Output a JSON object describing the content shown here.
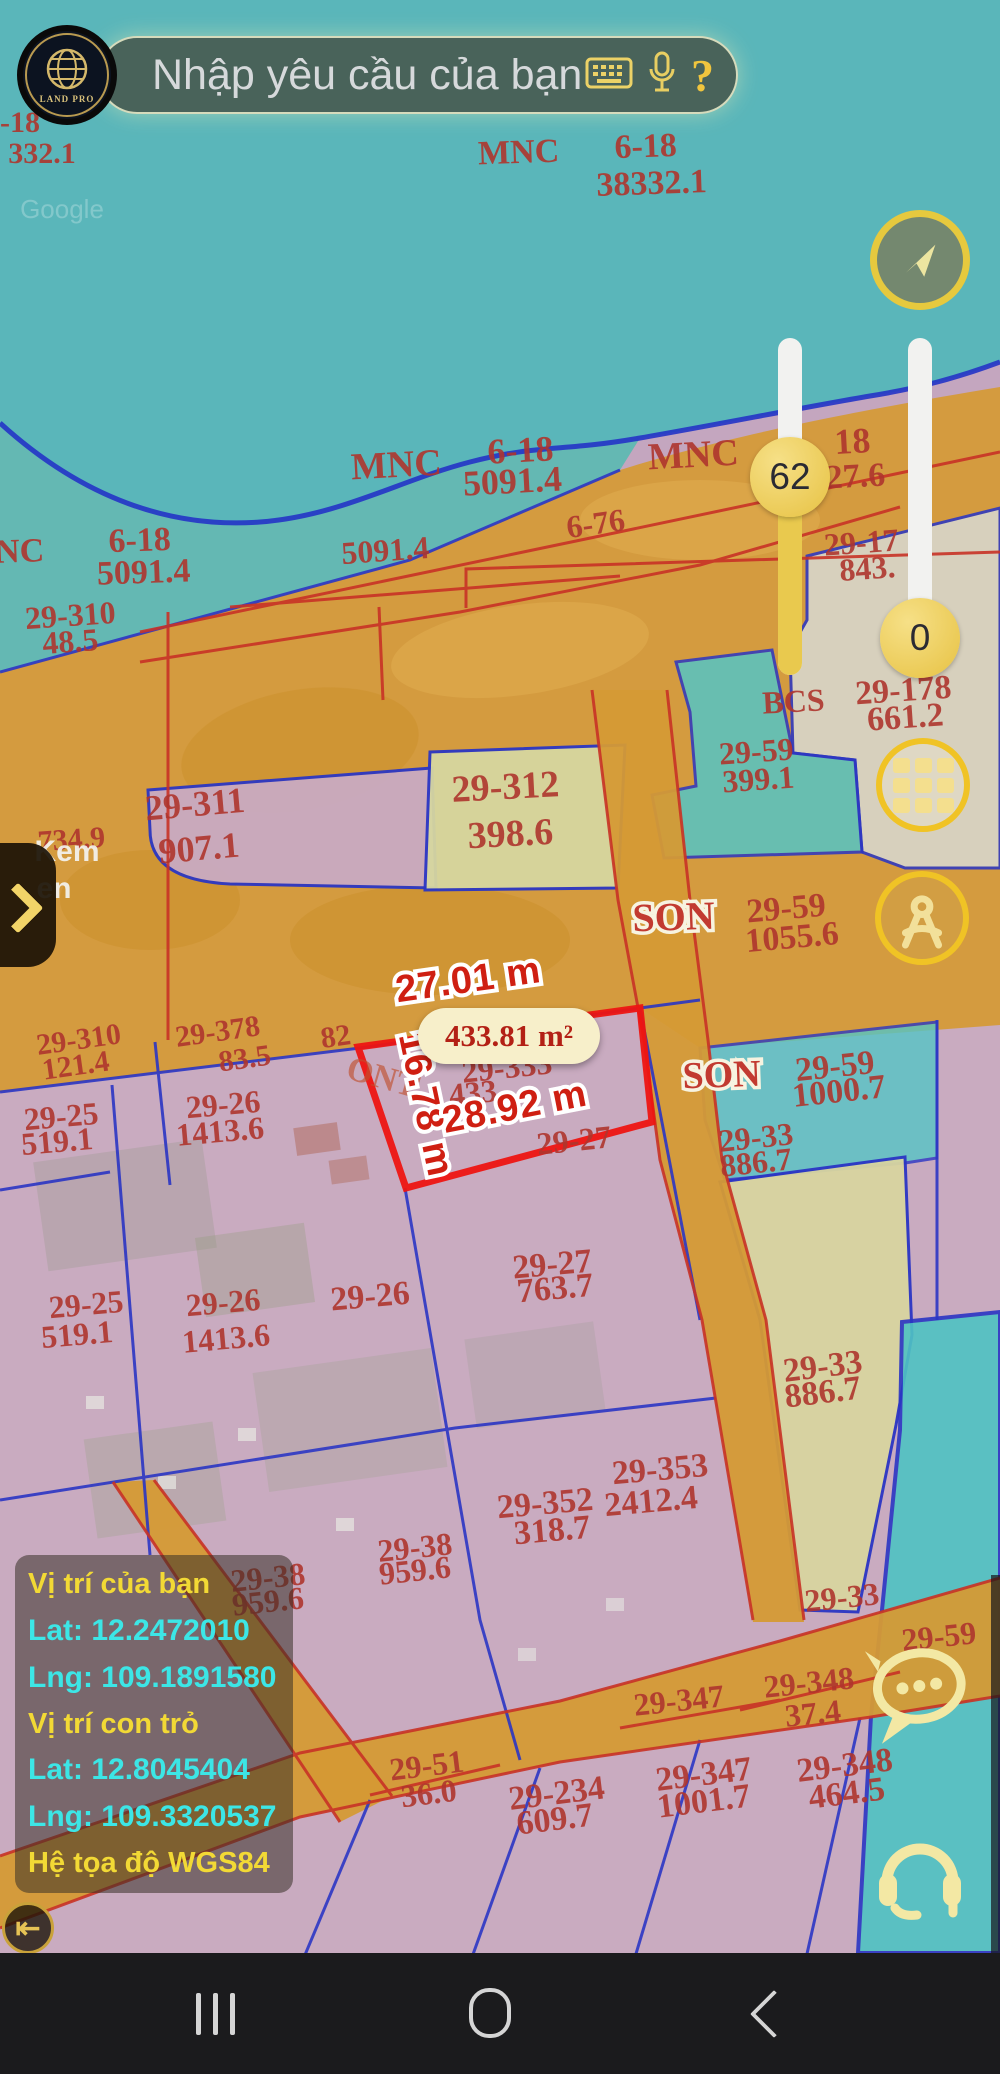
{
  "app": {
    "search_placeholder": "Nhập yêu cầu của bạn",
    "logo_text": "LAND PRO",
    "help_label": "?"
  },
  "sliders": {
    "left_value": "62",
    "right_value": "0"
  },
  "measurements": {
    "top_edge": "27.01 m",
    "left_edge": "16.78 m",
    "bottom_edge": "28.92 m",
    "area": "433.81 m²"
  },
  "info_box": {
    "title_you": "Vị trí của bạn",
    "lat_you": "Lat: 12.2472010",
    "lng_you": "Lng: 109.1891580",
    "title_cursor": "Vị trí con trỏ",
    "lat_cursor": "Lat: 12.8045404",
    "lng_cursor": "Lng: 109.3320537",
    "datum": "Hệ tọa độ WGS84"
  },
  "colors": {
    "water_teal": "#5ab6ba",
    "land_orange": "#d59a35",
    "parcel_pink": "#c4a6bf",
    "parcel_yellow": "#d8d5a0",
    "parcel_cyan": "#55c5c5",
    "line_blue": "#2b36c4",
    "line_red": "#c83226",
    "highlight_red": "#ee1512",
    "label_red": "#ae352d",
    "accent_gold": "#f0c325",
    "icon_pale_yellow": "#f3e8a4",
    "info_yellow": "#f2d935",
    "info_cyan": "#3ce6e6"
  },
  "map_labels": [
    {
      "t": "-18",
      "x": 20,
      "y": 132,
      "s": 30,
      "r": 0
    },
    {
      "t": "332.1",
      "x": 42,
      "y": 163,
      "s": 30,
      "r": 0
    },
    {
      "t": "MNC",
      "x": 519,
      "y": 163,
      "s": 34,
      "r": -2
    },
    {
      "t": "6-18",
      "x": 646,
      "y": 157,
      "s": 34,
      "r": -2
    },
    {
      "t": "38332.1",
      "x": 652,
      "y": 194,
      "s": 34,
      "r": -2
    },
    {
      "t": "Google",
      "x": 62,
      "y": 218,
      "s": 26,
      "r": 0,
      "c": "g"
    },
    {
      "t": "MNC",
      "x": 397,
      "y": 477,
      "s": 38,
      "r": -3
    },
    {
      "t": "6-18",
      "x": 521,
      "y": 462,
      "s": 36,
      "r": -3
    },
    {
      "t": "5091.4",
      "x": 513,
      "y": 493,
      "s": 36,
      "r": -3
    },
    {
      "t": "MNC",
      "x": 694,
      "y": 467,
      "s": 38,
      "r": -3
    },
    {
      "t": "18",
      "x": 853,
      "y": 453,
      "s": 36,
      "r": -3
    },
    {
      "t": "27.6",
      "x": 856,
      "y": 487,
      "s": 34,
      "r": -3
    },
    {
      "t": "NC",
      "x": 20,
      "y": 562,
      "s": 34,
      "r": -2
    },
    {
      "t": "6-18",
      "x": 140,
      "y": 551,
      "s": 34,
      "r": -2
    },
    {
      "t": "5091.4",
      "x": 144,
      "y": 583,
      "s": 34,
      "r": -2
    },
    {
      "t": "5091.4",
      "x": 386,
      "y": 561,
      "s": 32,
      "r": -4
    },
    {
      "t": "6-76",
      "x": 597,
      "y": 534,
      "s": 32,
      "r": -8
    },
    {
      "t": "29-310",
      "x": 71,
      "y": 626,
      "s": 32,
      "r": -4
    },
    {
      "t": "48.5",
      "x": 71,
      "y": 652,
      "s": 32,
      "r": -4
    },
    {
      "t": "29-17",
      "x": 862,
      "y": 553,
      "s": 32,
      "r": -4
    },
    {
      "t": "843.",
      "x": 868,
      "y": 579,
      "s": 32,
      "r": -4
    },
    {
      "t": "BCS",
      "x": 794,
      "y": 712,
      "s": 32,
      "r": -3
    },
    {
      "t": "29-178",
      "x": 904,
      "y": 701,
      "s": 34,
      "r": -4
    },
    {
      "t": "661.2",
      "x": 906,
      "y": 728,
      "s": 34,
      "r": -4
    },
    {
      "t": "29-59",
      "x": 757,
      "y": 762,
      "s": 32,
      "r": -4
    },
    {
      "t": "399.1",
      "x": 759,
      "y": 790,
      "s": 32,
      "r": -4
    },
    {
      "t": "29-312",
      "x": 506,
      "y": 799,
      "s": 38,
      "r": -3
    },
    {
      "t": "398.6",
      "x": 511,
      "y": 846,
      "s": 38,
      "r": -3
    },
    {
      "t": "29-311",
      "x": 196,
      "y": 816,
      "s": 36,
      "r": -5
    },
    {
      "t": "907.1",
      "x": 200,
      "y": 860,
      "s": 36,
      "r": -5
    },
    {
      "t": "734.9",
      "x": 72,
      "y": 849,
      "s": 30,
      "r": -4
    },
    {
      "t": "Kem",
      "x": 67,
      "y": 861,
      "s": 30,
      "r": 0,
      "c": "w"
    },
    {
      "t": "en",
      "x": 54,
      "y": 898,
      "s": 30,
      "r": 0,
      "c": "w"
    },
    {
      "t": "SON",
      "x": 674,
      "y": 930,
      "s": 40,
      "r": -2,
      "c": "ph"
    },
    {
      "t": "29-59",
      "x": 787,
      "y": 919,
      "s": 34,
      "r": -5
    },
    {
      "t": "1055.6",
      "x": 793,
      "y": 948,
      "s": 34,
      "r": -5
    },
    {
      "t": "29-310",
      "x": 80,
      "y": 1049,
      "s": 30,
      "r": -8
    },
    {
      "t": "121.4",
      "x": 77,
      "y": 1075,
      "s": 30,
      "r": -8
    },
    {
      "t": "29-378",
      "x": 219,
      "y": 1041,
      "s": 30,
      "r": -8
    },
    {
      "t": "83.5",
      "x": 246,
      "y": 1068,
      "s": 30,
      "r": -8
    },
    {
      "t": "82",
      "x": 337,
      "y": 1046,
      "s": 30,
      "r": -8
    },
    {
      "t": "ONT",
      "x": 380,
      "y": 1088,
      "s": 34,
      "r": 16,
      "c": "pf"
    },
    {
      "t": "29-333",
      "x": 508,
      "y": 1078,
      "s": 32,
      "r": -6
    },
    {
      "t": "433.",
      "x": 478,
      "y": 1103,
      "s": 32,
      "r": -6
    },
    {
      "t": "29-27",
      "x": 575,
      "y": 1151,
      "s": 32,
      "r": -6
    },
    {
      "t": "29-25",
      "x": 62,
      "y": 1127,
      "s": 32,
      "r": -5
    },
    {
      "t": "519.1",
      "x": 58,
      "y": 1152,
      "s": 32,
      "r": -5
    },
    {
      "t": "29-26",
      "x": 224,
      "y": 1115,
      "s": 32,
      "r": -5
    },
    {
      "t": "1413.6",
      "x": 221,
      "y": 1142,
      "s": 32,
      "r": -5
    },
    {
      "t": "SON",
      "x": 722,
      "y": 1087,
      "s": 38,
      "r": -2,
      "c": "ph"
    },
    {
      "t": "29-59",
      "x": 836,
      "y": 1077,
      "s": 34,
      "r": -6
    },
    {
      "t": "1000.7",
      "x": 840,
      "y": 1102,
      "s": 34,
      "r": -6
    },
    {
      "t": "29-33",
      "x": 757,
      "y": 1148,
      "s": 32,
      "r": -6
    },
    {
      "t": "886.7",
      "x": 757,
      "y": 1173,
      "s": 32,
      "r": -6
    },
    {
      "t": "29-27",
      "x": 553,
      "y": 1275,
      "s": 34,
      "r": -5
    },
    {
      "t": "763.7",
      "x": 556,
      "y": 1299,
      "s": 34,
      "r": -5
    },
    {
      "t": "29-26",
      "x": 371,
      "y": 1307,
      "s": 34,
      "r": -5
    },
    {
      "t": "29-25",
      "x": 87,
      "y": 1315,
      "s": 32,
      "r": -5
    },
    {
      "t": "519.1",
      "x": 78,
      "y": 1345,
      "s": 32,
      "r": -5
    },
    {
      "t": "29-26",
      "x": 224,
      "y": 1313,
      "s": 32,
      "r": -5
    },
    {
      "t": "1413.6",
      "x": 227,
      "y": 1349,
      "s": 32,
      "r": -5
    },
    {
      "t": "29-33",
      "x": 824,
      "y": 1377,
      "s": 34,
      "r": -7
    },
    {
      "t": "886.7",
      "x": 824,
      "y": 1403,
      "s": 34,
      "r": -7
    },
    {
      "t": "29-353",
      "x": 661,
      "y": 1480,
      "s": 34,
      "r": -5
    },
    {
      "t": "2412.4",
      "x": 652,
      "y": 1512,
      "s": 34,
      "r": -5
    },
    {
      "t": "29-352",
      "x": 546,
      "y": 1514,
      "s": 34,
      "r": -5
    },
    {
      "t": "318.7",
      "x": 553,
      "y": 1541,
      "s": 34,
      "r": -5
    },
    {
      "t": "29-38",
      "x": 416,
      "y": 1558,
      "s": 32,
      "r": -6
    },
    {
      "t": "959.6",
      "x": 416,
      "y": 1581,
      "s": 32,
      "r": -6
    },
    {
      "t": "29-38",
      "x": 269,
      "y": 1588,
      "s": 32,
      "r": -6
    },
    {
      "t": "959.6",
      "x": 269,
      "y": 1612,
      "s": 32,
      "r": -6
    },
    {
      "t": "29-33",
      "x": 843,
      "y": 1608,
      "s": 32,
      "r": -6
    },
    {
      "t": "29-59",
      "x": 940,
      "y": 1647,
      "s": 32,
      "r": -6
    },
    {
      "t": "29-347",
      "x": 680,
      "y": 1711,
      "s": 32,
      "r": -6
    },
    {
      "t": "29-348",
      "x": 810,
      "y": 1693,
      "s": 32,
      "r": -6
    },
    {
      "t": "37.4",
      "x": 814,
      "y": 1724,
      "s": 32,
      "r": -6
    },
    {
      "t": "29-347",
      "x": 705,
      "y": 1785,
      "s": 34,
      "r": -7
    },
    {
      "t": "1001.7",
      "x": 705,
      "y": 1812,
      "s": 34,
      "r": -7
    },
    {
      "t": "29-348",
      "x": 846,
      "y": 1776,
      "s": 34,
      "r": -7
    },
    {
      "t": "464.5",
      "x": 848,
      "y": 1804,
      "s": 34,
      "r": -7
    },
    {
      "t": "29-234",
      "x": 558,
      "y": 1804,
      "s": 34,
      "r": -7
    },
    {
      "t": "609.7",
      "x": 556,
      "y": 1830,
      "s": 34,
      "r": -7
    },
    {
      "t": "29-51",
      "x": 428,
      "y": 1776,
      "s": 32,
      "r": -7
    },
    {
      "t": "36.0",
      "x": 430,
      "y": 1804,
      "s": 32,
      "r": -7
    },
    {
      "t": "27.01 m",
      "x": 470,
      "y": 992,
      "s": 38,
      "r": -8,
      "c": "m"
    },
    {
      "t": "16.78 m",
      "x": 414,
      "y": 1107,
      "s": 38,
      "r": 78,
      "c": "m"
    },
    {
      "t": "28.92 m",
      "x": 517,
      "y": 1119,
      "s": 38,
      "r": -11,
      "c": "m"
    }
  ]
}
